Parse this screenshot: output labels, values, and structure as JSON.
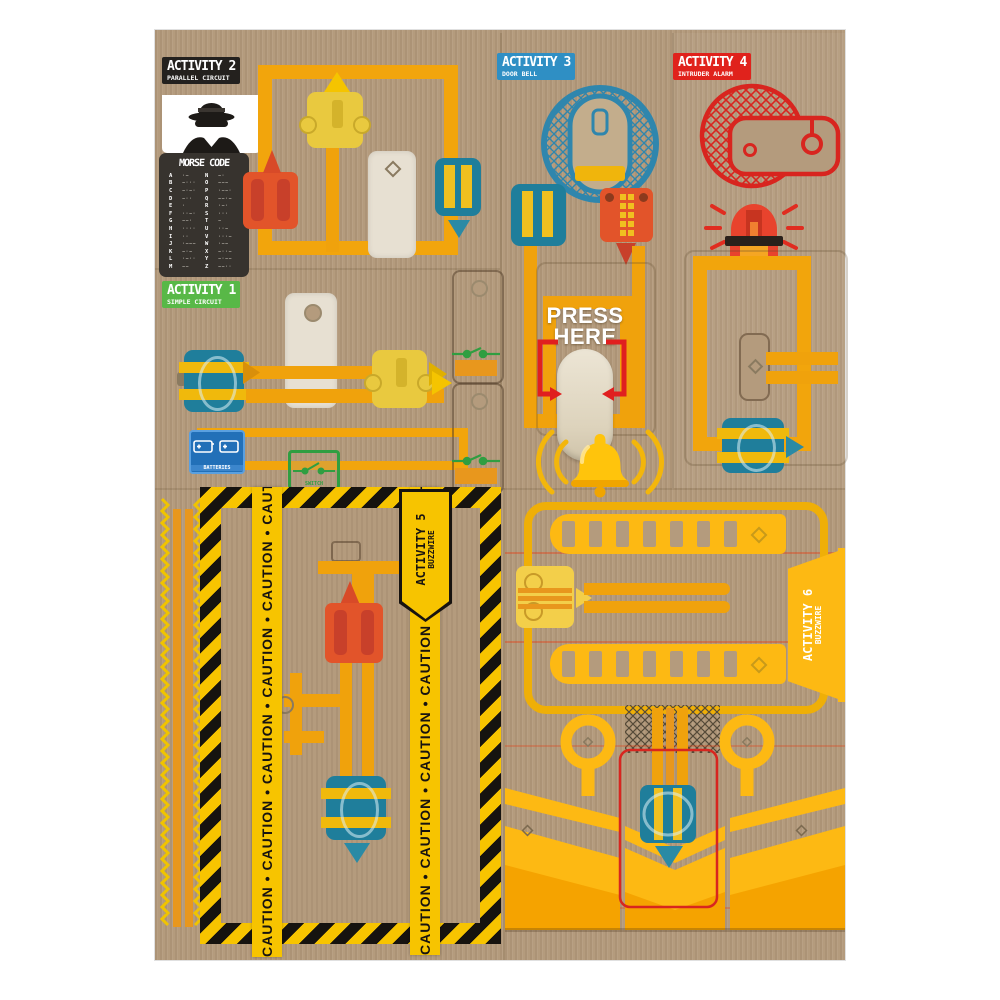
{
  "activities": {
    "a1": {
      "title": "ACTIVITY 1",
      "subtitle": "SIMPLE CIRCUIT"
    },
    "a2": {
      "title": "ACTIVITY 2",
      "subtitle": "PARALLEL CIRCUIT"
    },
    "a3": {
      "title": "ACTIVITY 3",
      "subtitle": "DOOR BELL"
    },
    "a4": {
      "title": "ACTIVITY 4",
      "subtitle": "INTRUDER ALARM"
    },
    "a5": {
      "title": "ACTIVITY 5",
      "subtitle": "BUZZWIRE"
    },
    "a6": {
      "title": "ACTIVITY 6",
      "subtitle": "BUZZWIRE"
    }
  },
  "morse": {
    "title": "MORSE CODE",
    "rows": [
      {
        "l": "A",
        "lc": "·−",
        "r": "N",
        "rc": "−·"
      },
      {
        "l": "B",
        "lc": "−···",
        "r": "O",
        "rc": "−−−"
      },
      {
        "l": "C",
        "lc": "−·−·",
        "r": "P",
        "rc": "·−−·"
      },
      {
        "l": "D",
        "lc": "−··",
        "r": "Q",
        "rc": "−−·−"
      },
      {
        "l": "E",
        "lc": "·",
        "r": "R",
        "rc": "·−·"
      },
      {
        "l": "F",
        "lc": "··−·",
        "r": "S",
        "rc": "···"
      },
      {
        "l": "G",
        "lc": "−−·",
        "r": "T",
        "rc": "−"
      },
      {
        "l": "H",
        "lc": "····",
        "r": "U",
        "rc": "··−"
      },
      {
        "l": "I",
        "lc": "··",
        "r": "V",
        "rc": "···−"
      },
      {
        "l": "J",
        "lc": "·−−−",
        "r": "W",
        "rc": "·−−"
      },
      {
        "l": "K",
        "lc": "−·−",
        "r": "X",
        "rc": "−··−"
      },
      {
        "l": "L",
        "lc": "·−··",
        "r": "Y",
        "rc": "−·−−"
      },
      {
        "l": "M",
        "lc": "−−",
        "r": "Z",
        "rc": "−−··"
      }
    ]
  },
  "labels": {
    "press1": "PRESS",
    "press2": "HERE",
    "batteries": "BATTERIES",
    "switch": "SWITCH"
  },
  "caution": {
    "tape": "CAUTION • CAUTION • CAUTION • CAUTION • CAUTION • CAUTION"
  },
  "colors": {
    "cardboard": "#b49b7d",
    "wire_yellow": "#f0a20c",
    "bright_yellow": "#ffc20e",
    "comb_yellow": "#fdb913",
    "caution_yellow": "#f7c400",
    "orange": "#e2542a",
    "red": "#d8251f",
    "teal": "#217e9c",
    "green": "#58b847",
    "blue": "#2f8fc4",
    "label_black": "#24211e",
    "cream": "#e7e0d2"
  }
}
